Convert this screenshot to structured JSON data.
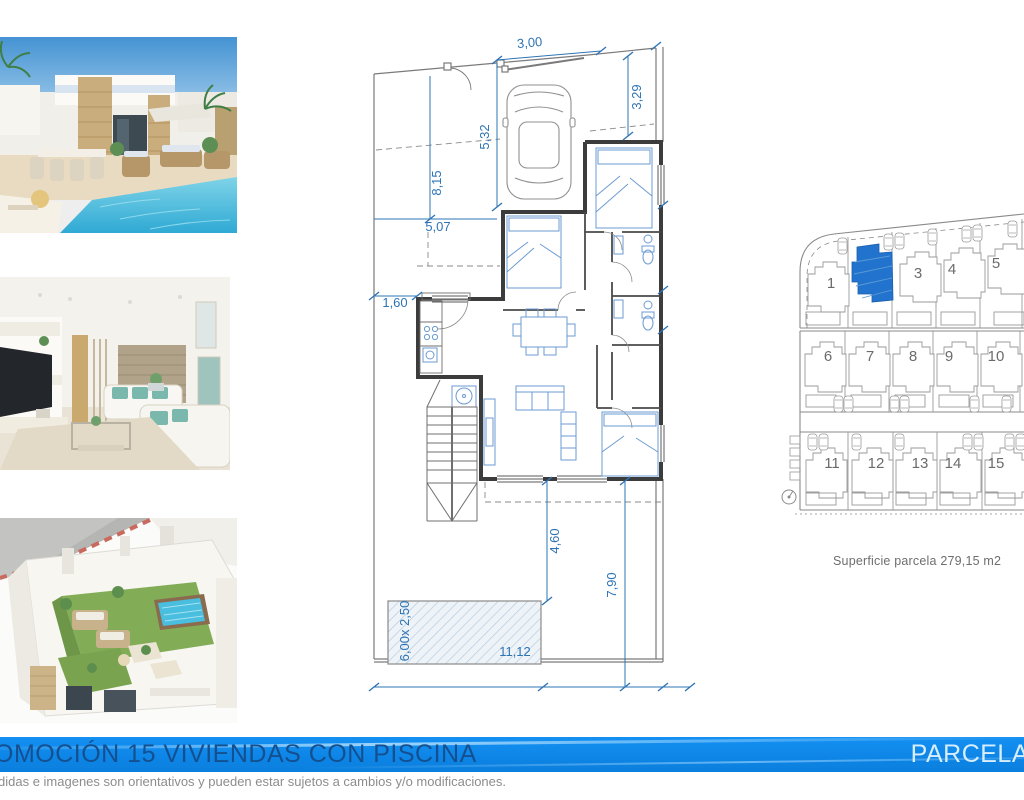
{
  "floor_plan": {
    "dims": {
      "top_width": "3,00",
      "right_setback": "3,29",
      "drive_depth": "5,32",
      "left_setback": "8,15",
      "front_width": "5,07",
      "side_passage": "1,60",
      "terrace_depth": "4,60",
      "garden_depth": "7,90",
      "garden_width": "11,12",
      "pool_size": "6,00x 2,50"
    }
  },
  "site_plan": {
    "plot_numbers": [
      "1",
      "3",
      "4",
      "5",
      "6",
      "7",
      "8",
      "9",
      "10",
      "11",
      "12",
      "13",
      "14",
      "15"
    ],
    "caption": "Superficie parcela 279,15 m2"
  },
  "footer": {
    "title": "OMOCIÓN 15 VIVIENDAS CON PISCINA",
    "parcel_label": "PARCELA",
    "disclaimer": "didas e imagenes son orientativos y pueden estar sujetos a cambios y/o modificaciones."
  },
  "colors": {
    "banner": "#0d85e6",
    "banner_title": "#14508f",
    "parcel_label": "#d6eefd",
    "dimension_text": "#2e74b5",
    "highlight_plot": "#2273cd",
    "plan_line": "#4a4a4a",
    "furniture_line": "#6b9bd2"
  }
}
